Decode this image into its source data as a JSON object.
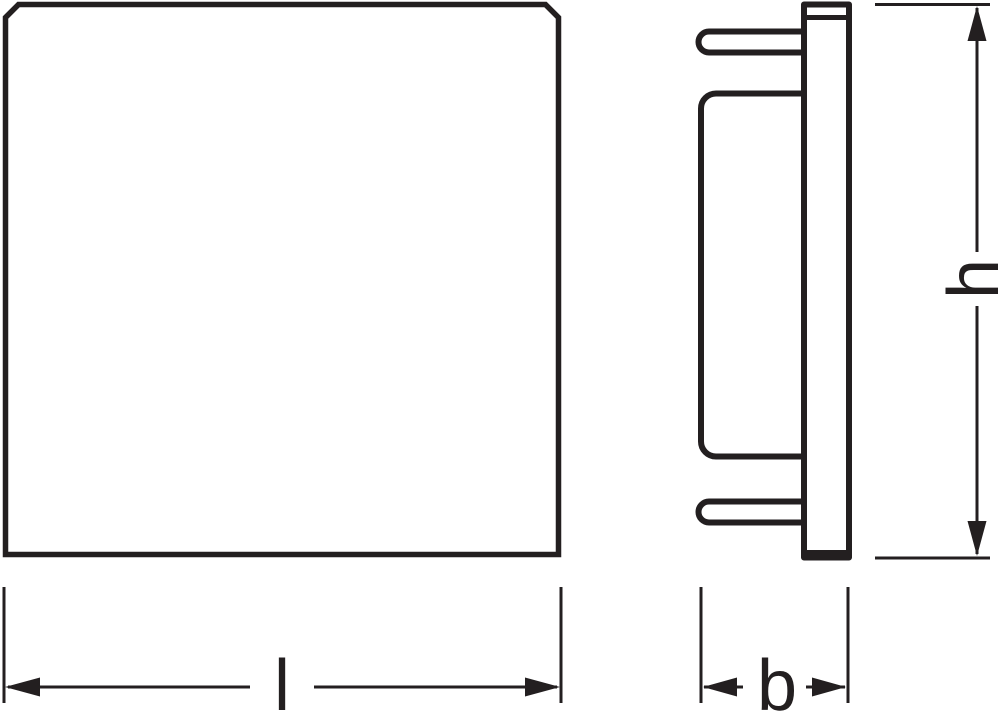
{
  "colors": {
    "line": "#231f20",
    "background": "#ffffff"
  },
  "dimensions": {
    "length": {
      "label": "l"
    },
    "depth": {
      "label": "b"
    },
    "height": {
      "label": "h"
    }
  }
}
